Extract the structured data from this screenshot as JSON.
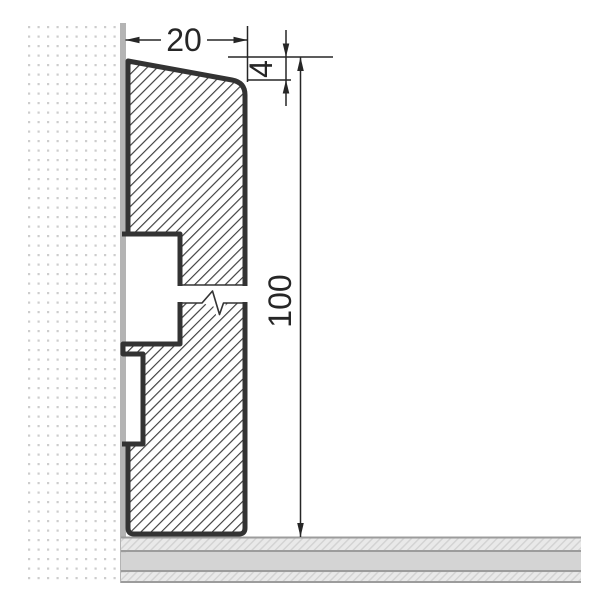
{
  "dimensions": {
    "width_label": "20",
    "chamfer_label": "4",
    "height_label": "100"
  },
  "colors": {
    "background": "#ffffff",
    "outline": "#333333",
    "hatch_line": "#3d3d3d",
    "dimension": "#262626",
    "wall_dot": "#cdcdcd",
    "wall_edge": "#b4b4b4",
    "floor_line": "#9c9c9c",
    "floor_solid": "#d4d4d4",
    "floor_hatch_bg": "#e9e9e9",
    "floor_hatch_line": "#d2d2d2"
  }
}
